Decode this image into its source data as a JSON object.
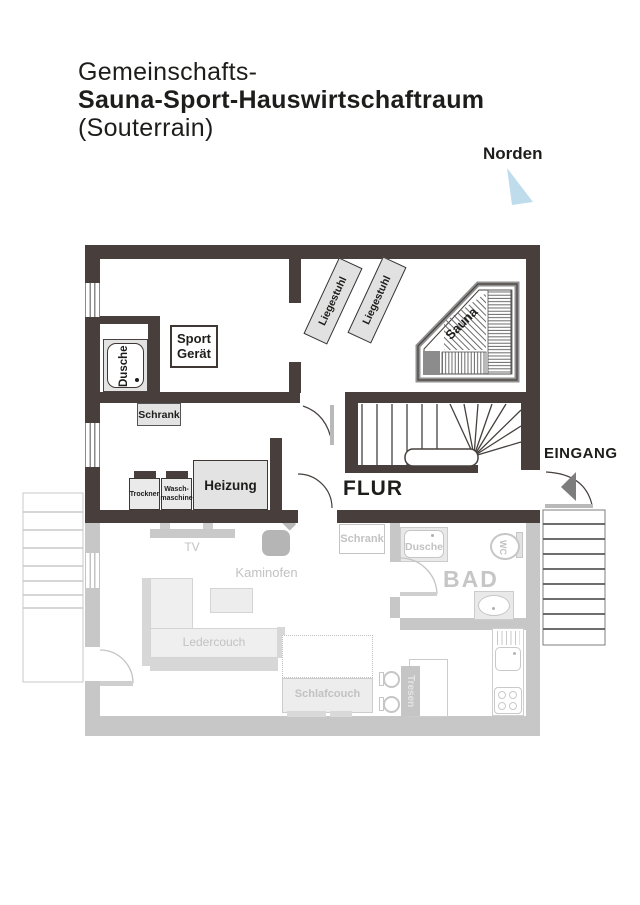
{
  "title": {
    "line1": "Gemeinschafts-",
    "line2": "Sauna-Sport-Hauswirtschaftraum",
    "line3": "(Souterrain)"
  },
  "compass": {
    "label": "Norden"
  },
  "upper_floor": {
    "dusche": "Dusche",
    "sport_line1": "Sport",
    "sport_line2": "Gerät",
    "schrank": "Schrank",
    "liegestuhl_1": "Liegestuhl",
    "liegestuhl_2": "Liegestuhl",
    "sauna": "Sauna",
    "trockner": "Trockner",
    "waschmaschine_line1": "Wasch-",
    "waschmaschine_line2": "maschine",
    "heizung": "Heizung",
    "flur": "FLUR",
    "eingang": "EINGANG"
  },
  "lower_floor": {
    "tv": "TV",
    "kaminofen": "Kaminofen",
    "schrank": "Schrank",
    "dusche": "Dusche",
    "wc": "WC",
    "bad": "BAD",
    "ledercouch": "Ledercouch",
    "schlafcouch": "Schlafcouch",
    "tresen": "Tresen"
  },
  "colors": {
    "wall_dark": "#483e3b",
    "wall_light": "#c7c7c7",
    "accent_north": "#bedcec",
    "grayed_text": "#c2c2c2",
    "dark_text": "#1d1d1b"
  }
}
